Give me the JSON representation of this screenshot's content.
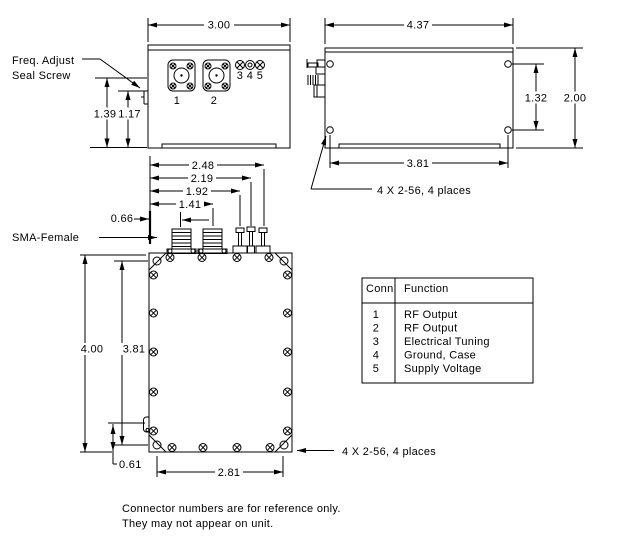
{
  "colors": {
    "line": "#000000",
    "background": "#ffffff"
  },
  "labels": {
    "freq_adjust_line1": "Freq. Adjust",
    "freq_adjust_line2": "Seal Screw",
    "sma_female": "SMA-Female",
    "side_screw_note": "4 X 2-56, 4 places",
    "top_screw_note": "4 X 2-56, 4 places",
    "note_line1": "Connector numbers are for reference only.",
    "note_line2": "They may not appear on unit."
  },
  "front_view": {
    "dims": {
      "width": "3.00",
      "connector_centerline": "1.39",
      "seal_screw_centerline": "1.17"
    },
    "connectors": {
      "c1": "1",
      "c2": "2",
      "c3": "3",
      "c4": "4",
      "c5": "5"
    }
  },
  "side_view": {
    "dims": {
      "width": "4.37",
      "hole_spacing_vertical": "1.32",
      "height": "2.00",
      "hole_spacing_horizontal": "3.81"
    }
  },
  "top_view": {
    "dims": {
      "pin5_offset": "2.48",
      "pin4_offset": "2.19",
      "pin3_offset": "1.92",
      "conn2_offset": "1.41",
      "conn1_offset": "0.66",
      "height": "4.00",
      "hole_spacing_vertical": "3.81",
      "seal_screw_offset": "0.61",
      "hole_spacing_horizontal": "2.81"
    }
  },
  "table": {
    "headers": {
      "conn": "Conn",
      "function": "Function"
    },
    "rows": [
      {
        "conn": "1",
        "function": "RF Output"
      },
      {
        "conn": "2",
        "function": "RF Output"
      },
      {
        "conn": "3",
        "function": "Electrical Tuning"
      },
      {
        "conn": "4",
        "function": "Ground, Case"
      },
      {
        "conn": "5",
        "function": "Supply Voltage"
      }
    ]
  }
}
